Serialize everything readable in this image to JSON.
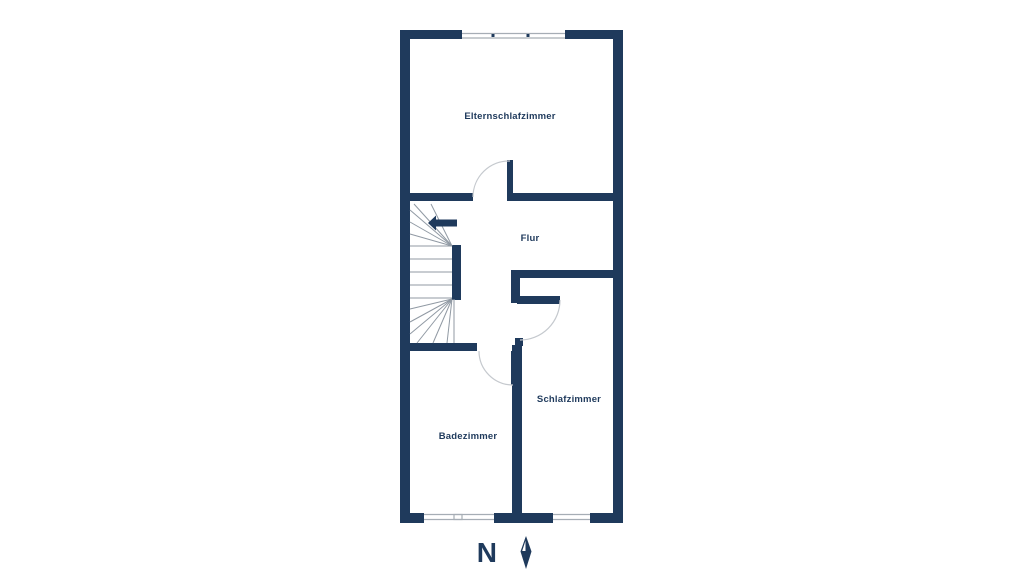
{
  "floor_plan": {
    "rooms": [
      {
        "label": "Elternschlafzimmer"
      },
      {
        "label": "Flur"
      },
      {
        "label": "Badezimmer"
      },
      {
        "label": "Schlafzimmer"
      }
    ],
    "compass": {
      "label": "N"
    },
    "icons": {
      "stairs_direction": "stairs-up-arrow-icon",
      "north_needle": "compass-needle-icon"
    },
    "colors": {
      "wall": "#1f3a5c",
      "label_text": "#1f3a5c",
      "stair_line": "#9099a3",
      "door_arc": "#c5c9ce",
      "window_line": "#a6adb5",
      "background": "#ffffff"
    }
  }
}
